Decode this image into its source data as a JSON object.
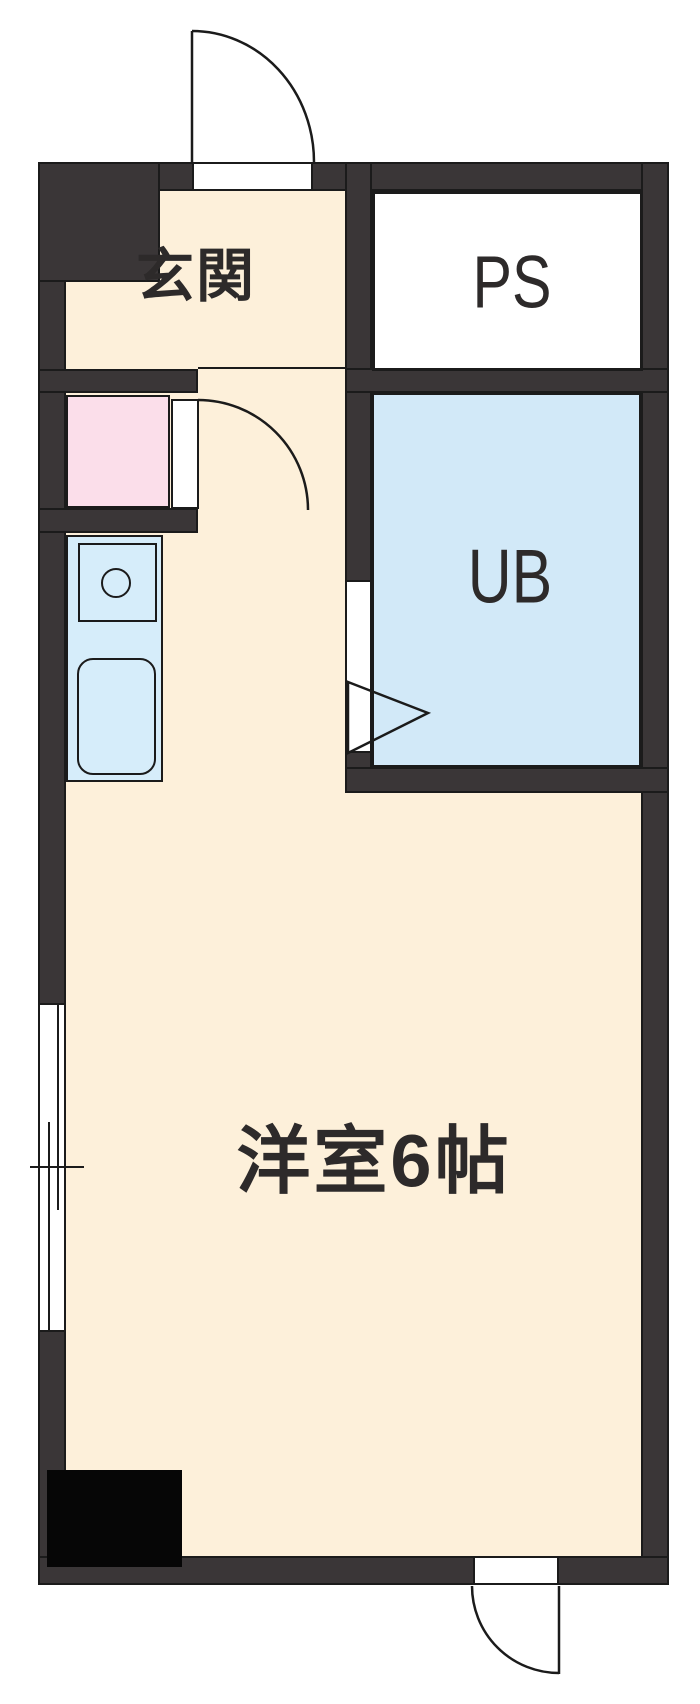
{
  "floorplan": {
    "kind": "japanese-apartment-floor-plan",
    "rooms": [
      {
        "id": "genkan",
        "label": "玄関"
      },
      {
        "id": "pipe_space",
        "label": "PS"
      },
      {
        "id": "unit_bath",
        "label": "UB"
      },
      {
        "id": "main_room",
        "label": "洋室6帖"
      }
    ],
    "colors": {
      "wall": "#3a3637",
      "outline": "#1b1b1b",
      "floor": "#fdf0da",
      "unit_bath_fill": "#d2e9f8",
      "kitchen_fill": "#d6edfa",
      "washer_pad_fill": "#fbdeea",
      "shaft_fill": "#060606",
      "text": "#2d2a2a",
      "background": "#ffffff"
    }
  }
}
